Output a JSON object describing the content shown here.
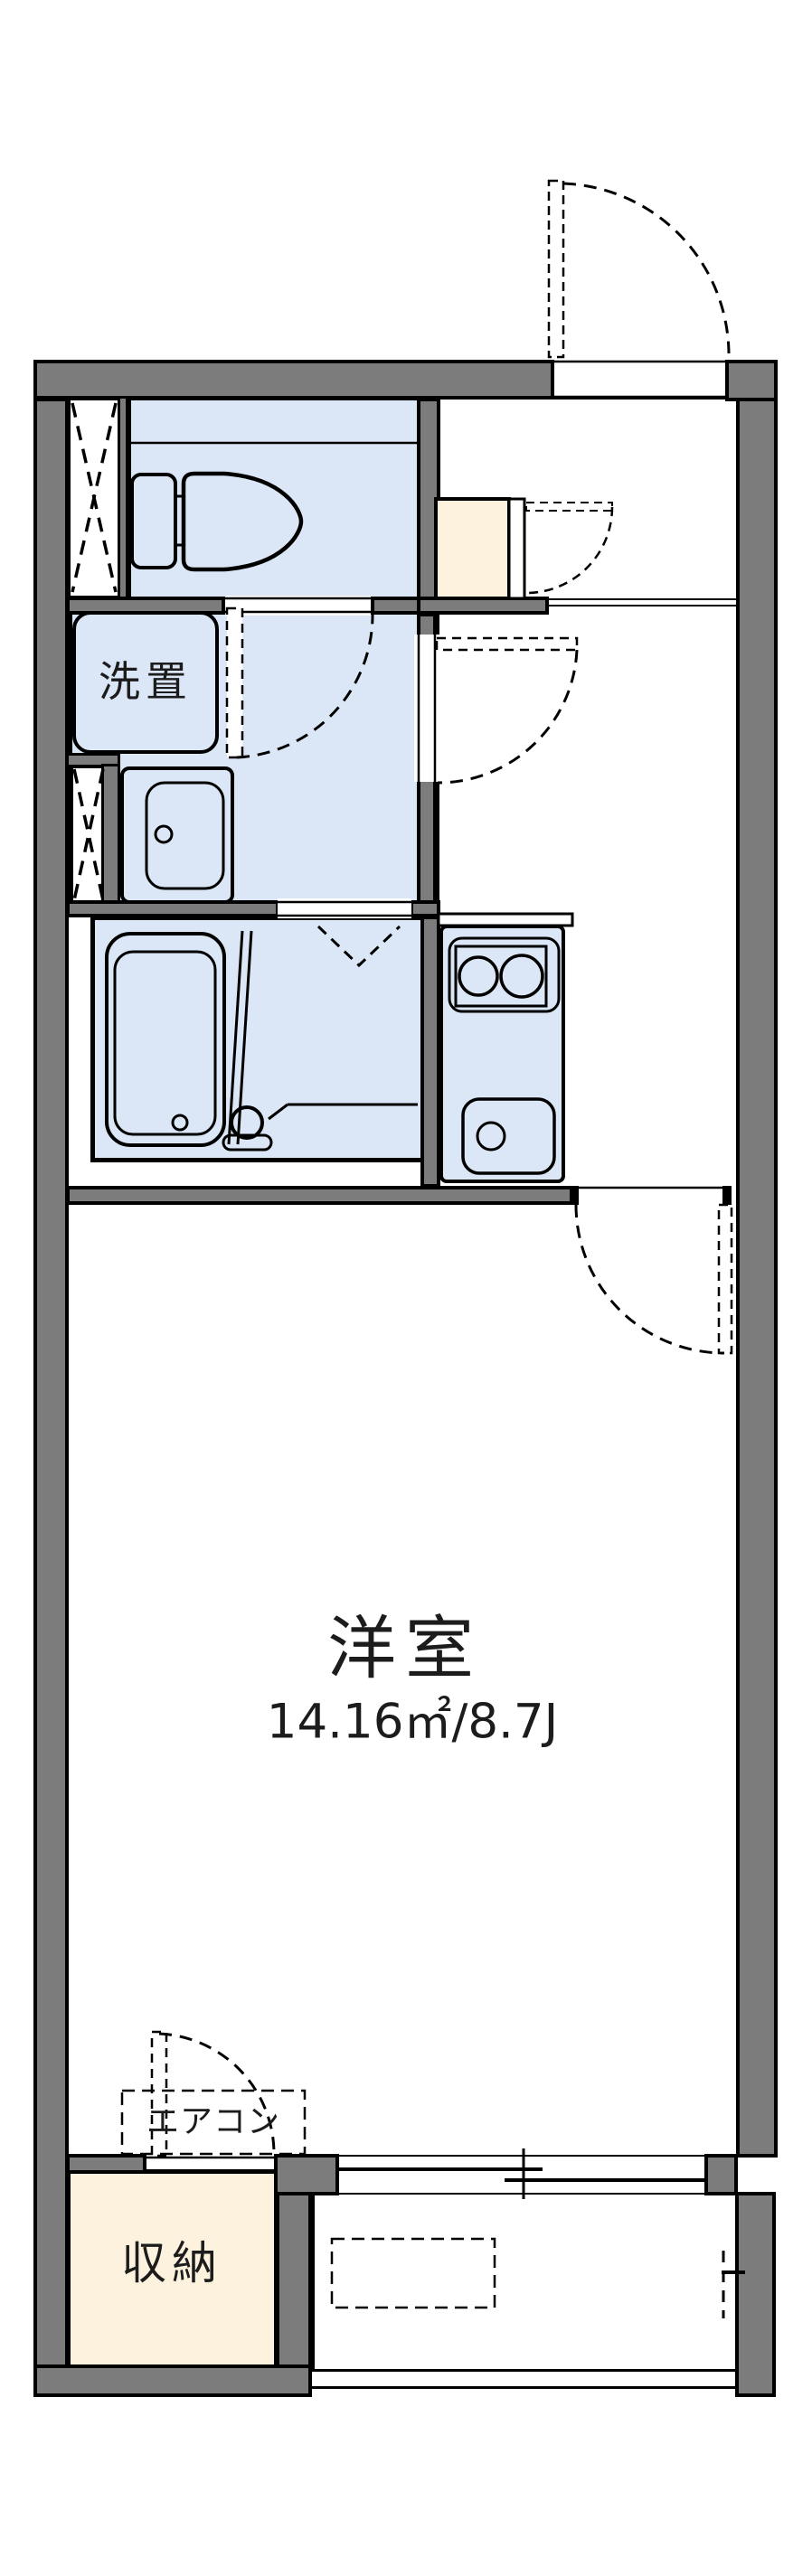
{
  "floorplan": {
    "labels": {
      "washer": "洗置",
      "main_room": "洋室",
      "main_room_area": "14.16㎡/8.7J",
      "aircon": "エアコン",
      "storage": "収納"
    },
    "colors": {
      "wall_gray": "#7c7c7c",
      "wet_area_blue": "#dbe6f6",
      "storage_beige": "#fcf2de",
      "line_black": "#000000",
      "floor_white": "#ffffff"
    }
  }
}
